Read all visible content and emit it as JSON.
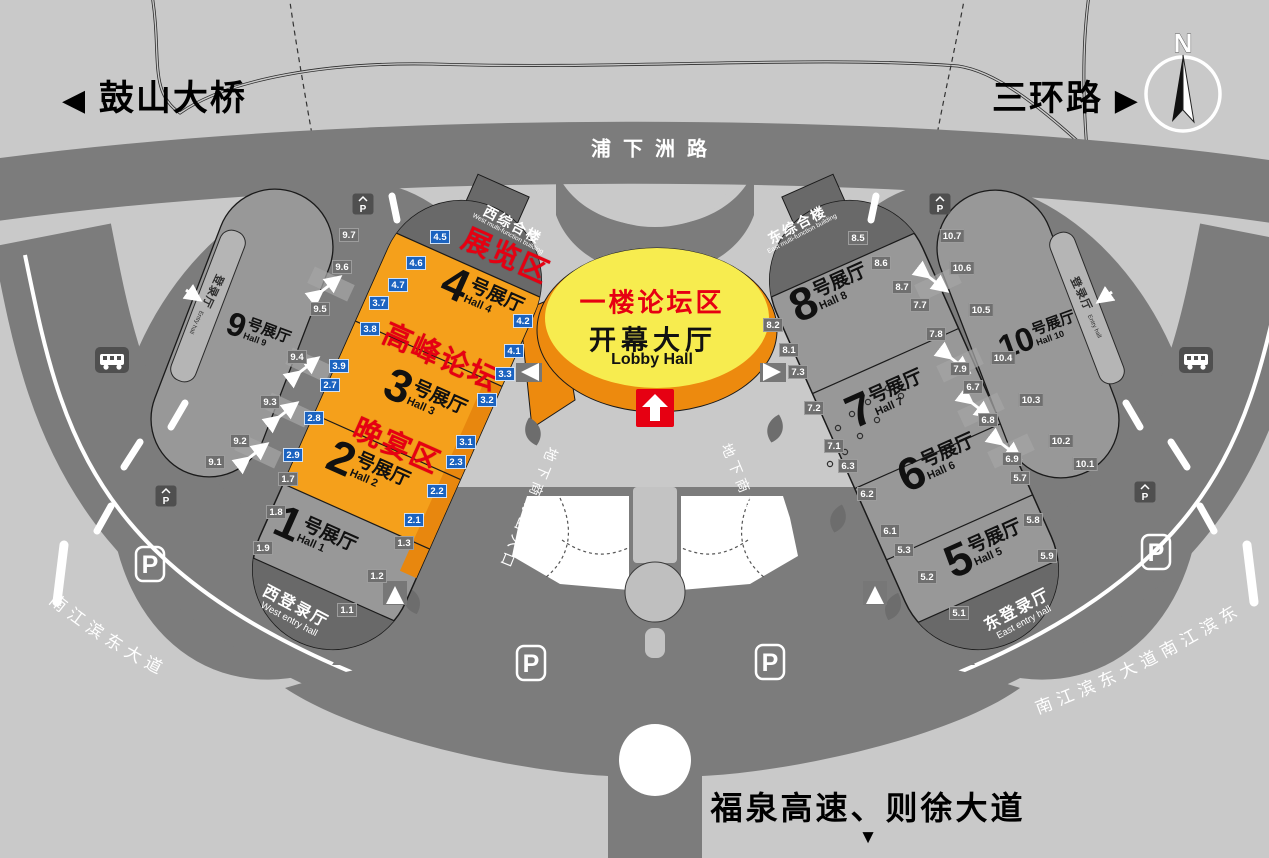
{
  "signs": {
    "top_left_road": "鼓山大桥",
    "top_right_road": "三环路",
    "top_road": "浦下洲路",
    "bottom_road": "福泉高速、则徐大道",
    "left_riverside_road": "南江滨东大道",
    "right_riverside_road": "南江滨东大道南江滨东",
    "mall_entrance_west": "地下商场出入口",
    "mall_entrance_east": "地下商场出入口",
    "arrow_left": "◀",
    "arrow_right": "▶",
    "arrow_down": "▼"
  },
  "compass": {
    "label": "N"
  },
  "lobby": {
    "zone": "一楼论坛区",
    "title": "开幕大厅",
    "subtitle": "Lobby Hall"
  },
  "zones": {
    "exhibition": "展览区",
    "summit": "高峰论坛",
    "banquet": "晚宴区"
  },
  "buildings": {
    "west_complex": {
      "cn": "西综合楼",
      "en": "West multi-function building"
    },
    "east_complex": {
      "cn": "东综合楼",
      "en": "East multi-function building"
    },
    "west_entry": {
      "cn": "西登录厅",
      "en": "West entry hall"
    },
    "east_entry": {
      "cn": "东登录厅",
      "en": "East entry hall"
    },
    "west_side_entry": {
      "cn": "登录厅",
      "en": "Entry hall"
    },
    "east_side_entry": {
      "cn": "登录厅",
      "en": "Entry hall"
    }
  },
  "halls": {
    "h1": {
      "no": "1",
      "suffix": "号展厅",
      "en": "Hall 1"
    },
    "h2": {
      "no": "2",
      "suffix": "号展厅",
      "en": "Hall 2"
    },
    "h3": {
      "no": "3",
      "suffix": "号展厅",
      "en": "Hall 3"
    },
    "h4": {
      "no": "4",
      "suffix": "号展厅",
      "en": "Hall 4"
    },
    "h5": {
      "no": "5",
      "suffix": "号展厅",
      "en": "Hall 5"
    },
    "h6": {
      "no": "6",
      "suffix": "号展厅",
      "en": "Hall 6"
    },
    "h7": {
      "no": "7",
      "suffix": "号展厅",
      "en": "Hall 7"
    },
    "h8": {
      "no": "8",
      "suffix": "号展厅",
      "en": "Hall 8"
    },
    "h9": {
      "no": "9",
      "suffix": "号展厅",
      "en": "Hall 9"
    },
    "h10": {
      "no": "10",
      "suffix": "号展厅",
      "en": "Hall 10"
    }
  },
  "gates": {
    "g1_1": "1.1",
    "g1_2": "1.2",
    "g1_3": "1.3",
    "g1_7": "1.7",
    "g1_8": "1.8",
    "g1_9": "1.9",
    "g2_1": "2.1",
    "g2_2": "2.2",
    "g2_3": "2.3",
    "g2_7": "2.7",
    "g2_8": "2.8",
    "g2_9": "2.9",
    "g3_1": "3.1",
    "g3_2": "3.2",
    "g3_3": "3.3",
    "g3_7": "3.7",
    "g3_8": "3.8",
    "g3_9": "3.9",
    "g4_1": "4.1",
    "g4_2": "4.2",
    "g4_5": "4.5",
    "g4_6": "4.6",
    "g4_7": "4.7",
    "g5_1": "5.1",
    "g5_2": "5.2",
    "g5_3": "5.3",
    "g5_7": "5.7",
    "g5_8": "5.8",
    "g5_9": "5.9",
    "g6_1": "6.1",
    "g6_2": "6.2",
    "g6_3": "6.3",
    "g6_7": "6.7",
    "g6_8": "6.8",
    "g6_9": "6.9",
    "g7_1": "7.1",
    "g7_2": "7.2",
    "g7_3": "7.3",
    "g7_7": "7.7",
    "g7_8": "7.8",
    "g7_9": "7.9",
    "g8_1": "8.1",
    "g8_2": "8.2",
    "g8_5": "8.5",
    "g8_6": "8.6",
    "g8_7": "8.7",
    "g9_1": "9.1",
    "g9_2": "9.2",
    "g9_3": "9.3",
    "g9_4": "9.4",
    "g9_5": "9.5",
    "g9_6": "9.6",
    "g9_7": "9.7",
    "g10_1": "10.1",
    "g10_2": "10.2",
    "g10_3": "10.3",
    "g10_4": "10.4",
    "g10_5": "10.5",
    "g10_6": "10.6",
    "g10_7": "10.7"
  },
  "icons": {
    "parking": "P",
    "parking_small": "P"
  }
}
